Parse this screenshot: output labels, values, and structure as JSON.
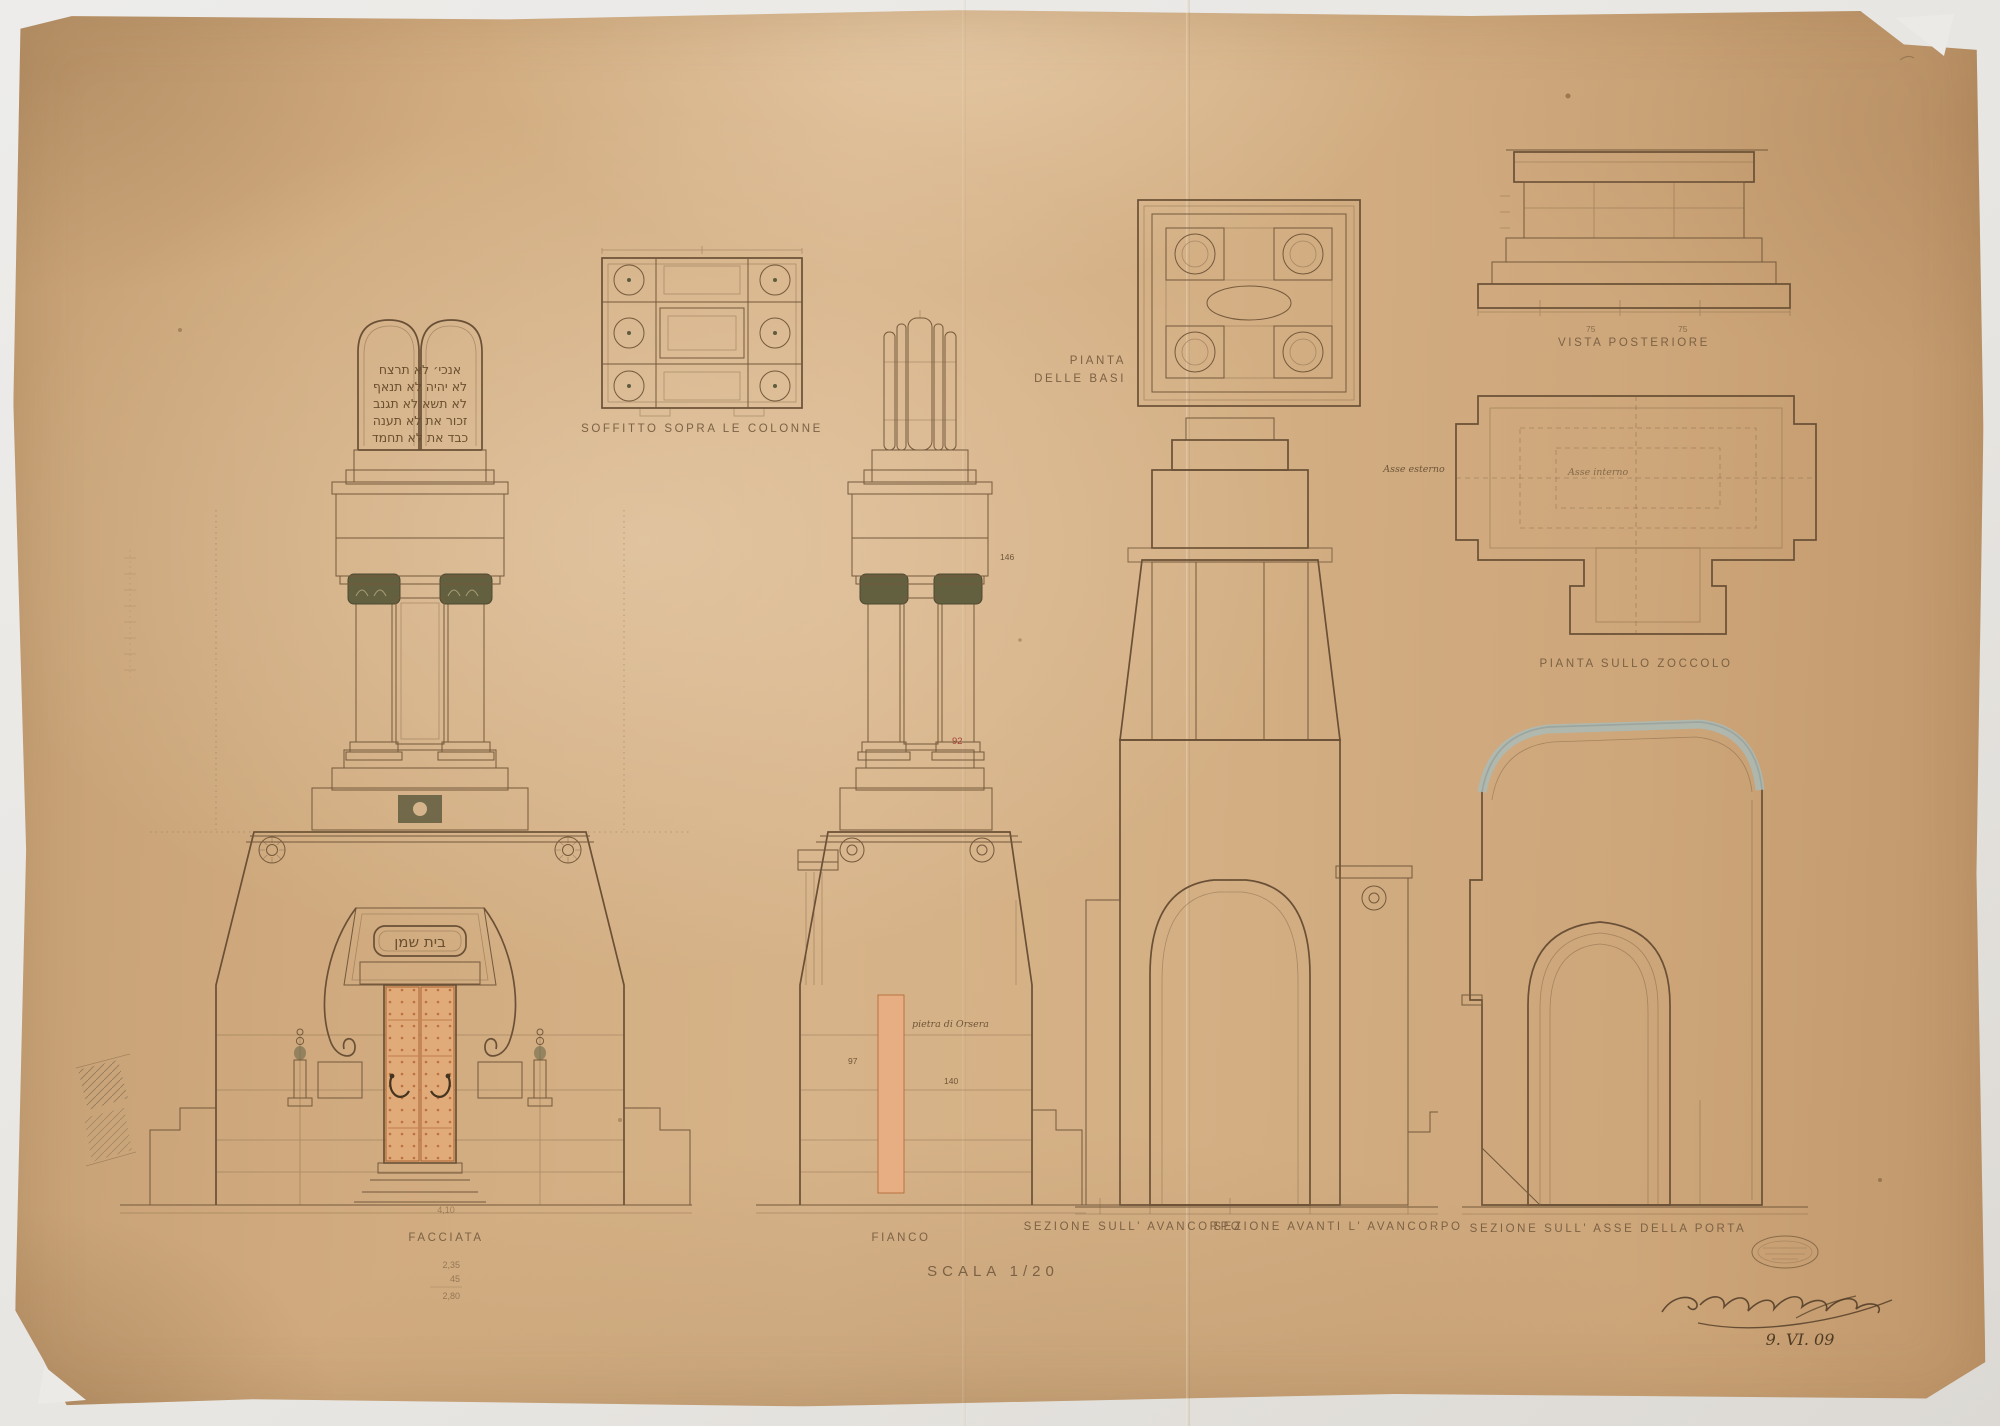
{
  "sheet": {
    "scale_label": "SCALA 1/20",
    "date": "9. VI. 09"
  },
  "views": {
    "facciata": {
      "label": "FACCIATA"
    },
    "fianco": {
      "label": "FIANCO"
    },
    "soffitto": {
      "label": "SOFFITTO SOPRA LE COLONNE"
    },
    "pianta_basi": {
      "label_line1": "PIANTA",
      "label_line2": "DELLE BASI"
    },
    "vista_posteriore": {
      "label": "VISTA POSTERIORE"
    },
    "pianta_zoccolo": {
      "label": "PIANTA SULLO ZOCCOLO"
    },
    "sezione_avancorpo": {
      "label": "SEZIONE SULL' AVANCORPO"
    },
    "sezione_avanti_avancorpo": {
      "label": "SEZIONE AVANTI L' AVANCORPO"
    },
    "sezione_asse_porta": {
      "label": "SEZIONE SULL' ASSE DELLA PORTA"
    }
  },
  "inscriptions": {
    "tablet_line1": "אנכי׳  לא תרצח",
    "tablet_line2": "לא יהיה  לא תנאף",
    "tablet_line3": "לא תשא  לא תגנב",
    "tablet_line4": "זכור את  לא תענה",
    "tablet_line5": "כבד את  לא תחמד",
    "door_lintel": "בית שמן"
  },
  "notes": {
    "asse_esterno": "Asse esterno",
    "asse_interno": "Asse interno",
    "material": "pietra di Orsera",
    "pencil_total": "4,10",
    "pencil_calc_1": "2,35",
    "pencil_calc_2": "45",
    "pencil_calc_3": "2,80"
  },
  "dimensions": {
    "fianco_146": "146",
    "fianco_92": "92",
    "fianco_97": "97",
    "fianco_140": "140",
    "vista_75a": "75",
    "vista_75b": "75"
  },
  "colors": {
    "paper": "#d2ac80",
    "ink": "#73593d",
    "wash_blue": "#a9bcba",
    "wash_green": "#8a9070",
    "door_terracotta": "#dfa273",
    "accent_red": "#a5453a"
  }
}
